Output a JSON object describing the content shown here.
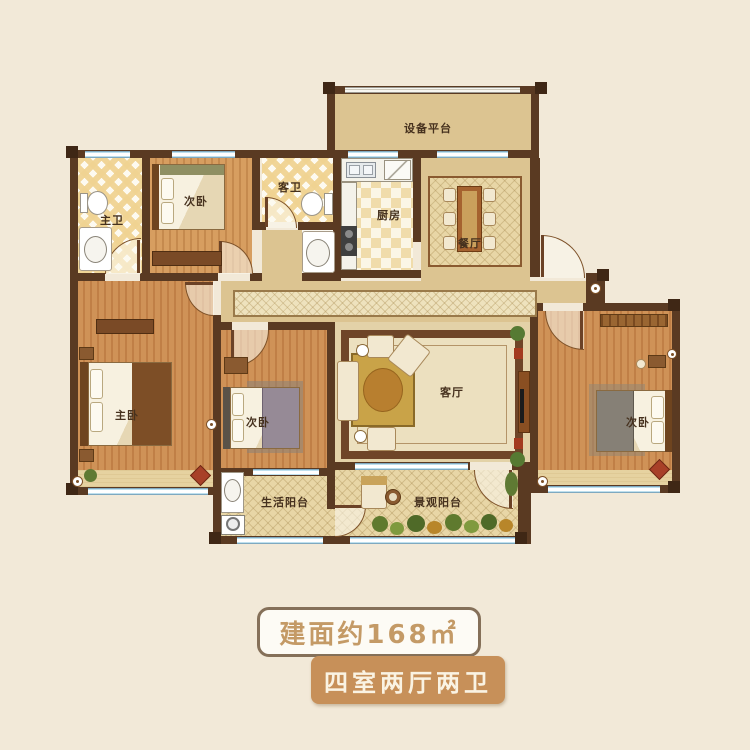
{
  "plan": {
    "labels": {
      "equipment_platform": "设备平台",
      "master_bath": "主卫",
      "bedroom_nw": "次卧",
      "guest_bath": "客卫",
      "kitchen": "厨房",
      "dining": "餐厅",
      "master_bedroom": "主卧",
      "bedroom_mid": "次卧",
      "living": "客厅",
      "bedroom_e": "次卧",
      "life_balcony": "生活阳台",
      "view_balcony": "景观阳台"
    }
  },
  "badges": {
    "area": "建面约168㎡",
    "layout": "四室两厅两卫"
  },
  "colors": {
    "background": "#f2e9d8",
    "wall": "#5a3a22",
    "window_glass": "#a9d2e4",
    "wood_floor": "#c98b52",
    "tan_floor": "#dcc491",
    "badge_area_text": "#c49a66",
    "badge_layout_bg": "#c79059",
    "badge_layout_text": "#faf3e3"
  }
}
